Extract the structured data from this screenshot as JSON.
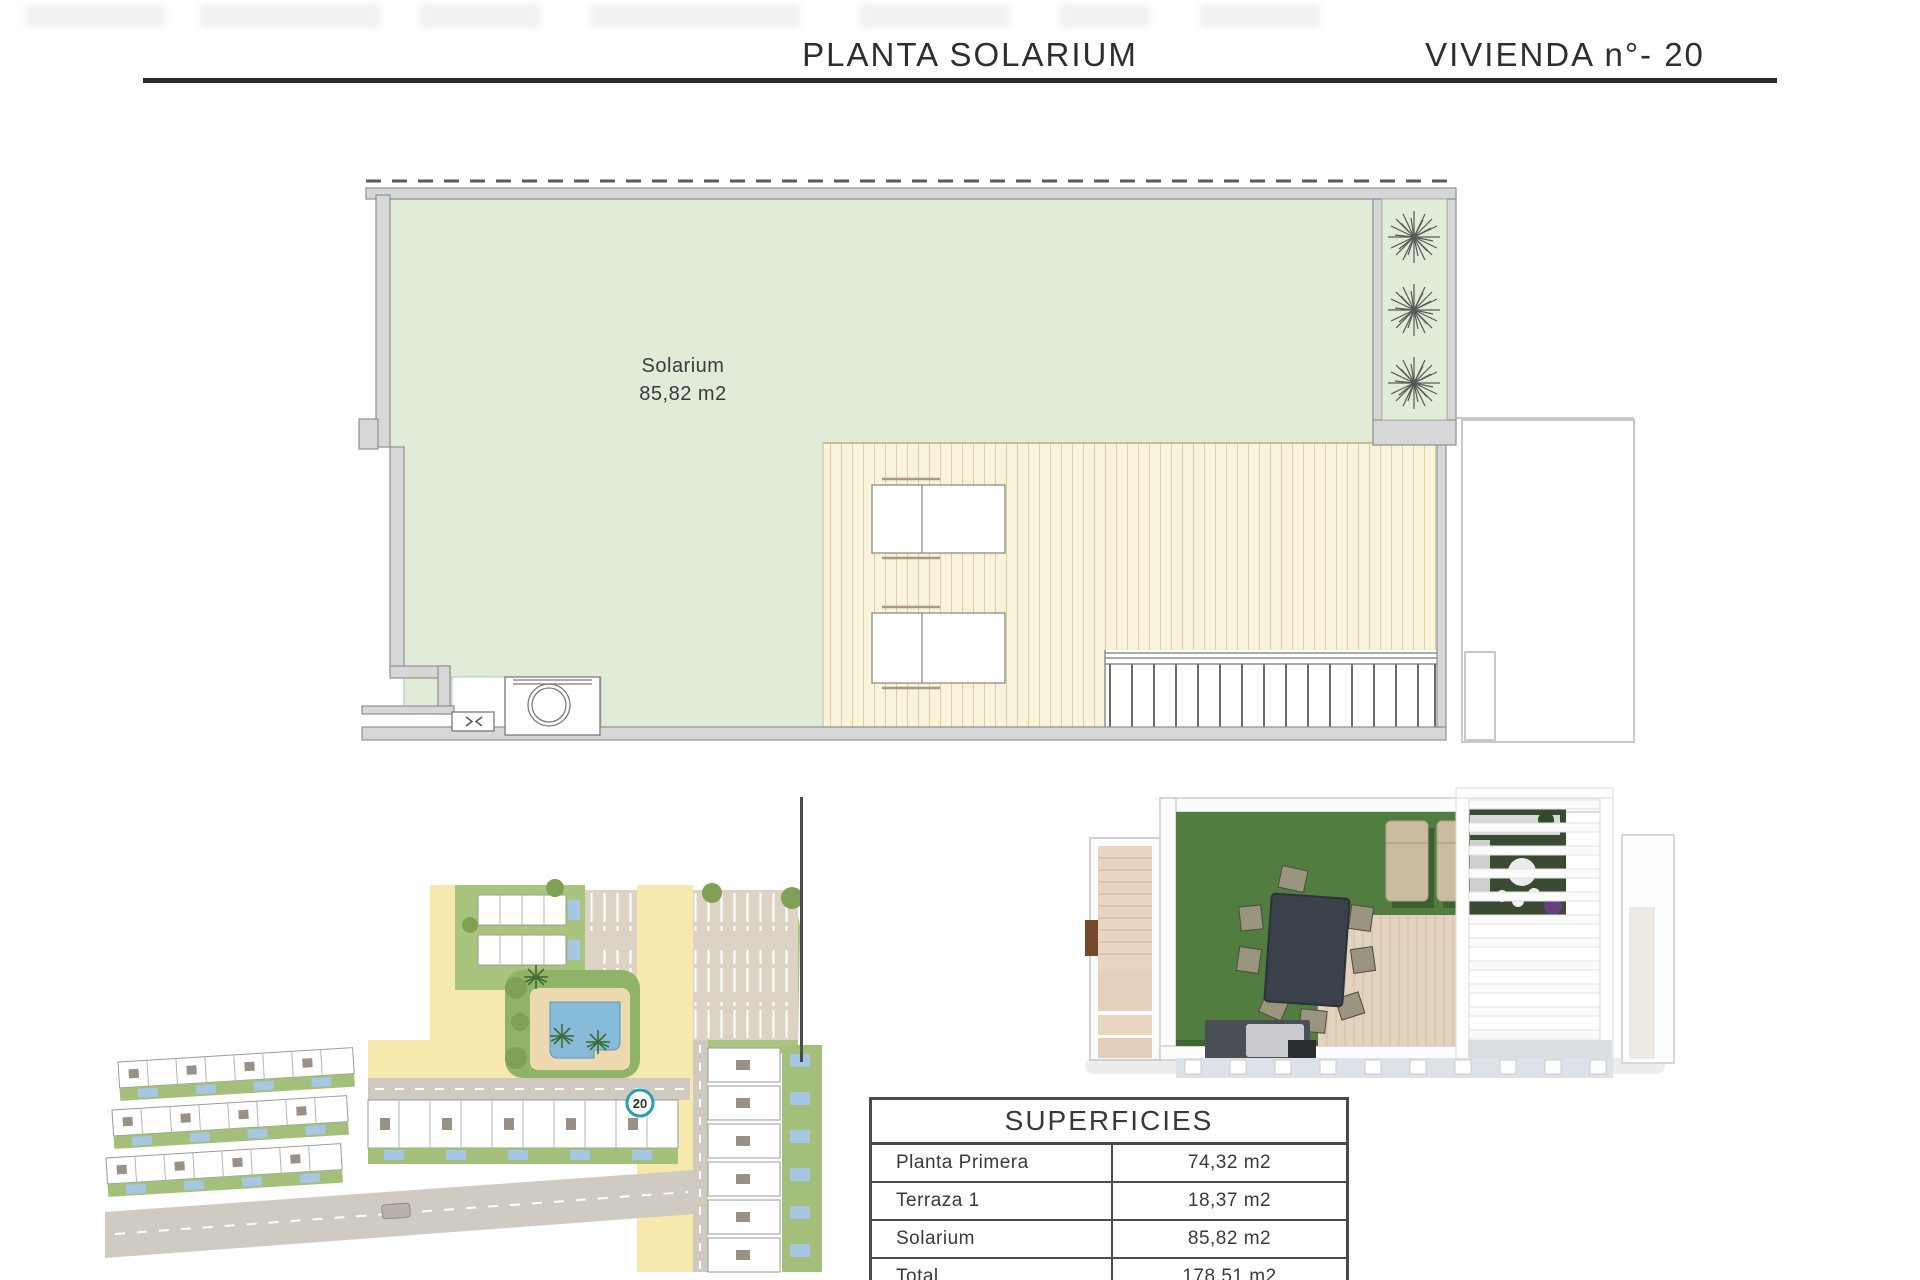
{
  "header": {
    "title": "PLANTA SOLARIUM",
    "unit_label": "VIVIENDA n°- 20"
  },
  "floor_plan": {
    "room_label": "Solarium",
    "room_area": "85,82 m2"
  },
  "site_plan": {
    "unit_marker": "20"
  },
  "superficies_table": {
    "title": "SUPERFICIES",
    "rows": [
      {
        "label": "Planta Primera",
        "value": "74,32 m2"
      },
      {
        "label": "Terraza 1",
        "value": "18,37 m2"
      },
      {
        "label": "Solarium",
        "value": "85,82 m2"
      },
      {
        "label": "Total",
        "value": "178,51 m2"
      }
    ]
  }
}
